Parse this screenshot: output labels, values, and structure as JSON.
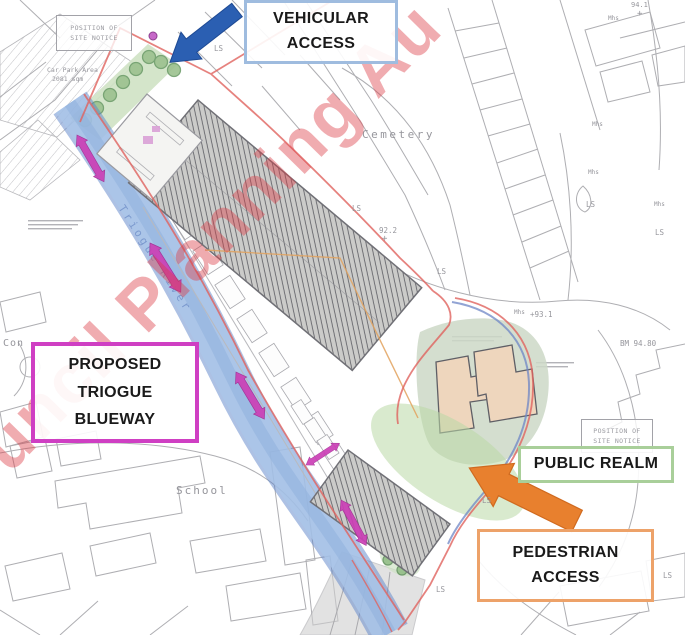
{
  "watermark": {
    "text": "uncil Planning Au"
  },
  "callouts": {
    "vehicular_access": {
      "lines": [
        "VEHICULAR",
        "ACCESS"
      ]
    },
    "proposed_triogue_blueway": {
      "lines": [
        "PROPOSED",
        "TRIOGUE",
        "BLUEWAY"
      ]
    },
    "public_realm": {
      "lines": [
        "PUBLIC REALM"
      ]
    },
    "pedestrian_access": {
      "lines": [
        "PEDESTRIAN",
        "ACCESS"
      ]
    }
  },
  "river_label": "Triogue River",
  "site_notices": [
    {
      "lines": [
        "POSITION OF",
        "SITE NOTICE"
      ],
      "x": 56,
      "y": 15,
      "w": 74,
      "h": 34
    },
    {
      "lines": [
        "POSITION OF",
        "SITE NOTICE"
      ],
      "x": 581,
      "y": 419,
      "w": 70,
      "h": 32
    }
  ],
  "map_labels": [
    {
      "text": "Cemetery",
      "x": 362,
      "y": 128,
      "size": 11,
      "ls": 2.5
    },
    {
      "text": "School",
      "x": 176,
      "y": 484,
      "size": 11,
      "ls": 2
    },
    {
      "text": "Con",
      "x": 3,
      "y": 338,
      "size": 10,
      "ls": 1
    },
    {
      "text": "Car Park Area",
      "x": 47,
      "y": 66,
      "size": 6.5
    },
    {
      "text": "2081 sqm",
      "x": 52,
      "y": 75,
      "size": 6.5
    },
    {
      "text": "92.2",
      "x": 379,
      "y": 226,
      "size": 7.5
    },
    {
      "text": "+",
      "x": 382,
      "y": 234,
      "size": 9
    },
    {
      "text": "+93.1",
      "x": 530,
      "y": 310,
      "size": 7.5
    },
    {
      "text": "BM 94.80",
      "x": 620,
      "y": 339,
      "size": 7.5
    },
    {
      "text": "94.1",
      "x": 631,
      "y": 1,
      "size": 7
    },
    {
      "text": "+",
      "x": 637,
      "y": 9,
      "size": 9
    },
    {
      "text": "LS",
      "x": 214,
      "y": 44,
      "size": 7.5
    },
    {
      "text": "LS",
      "x": 352,
      "y": 204,
      "size": 7.5
    },
    {
      "text": "LS",
      "x": 586,
      "y": 200,
      "size": 7.5
    },
    {
      "text": "LS",
      "x": 655,
      "y": 228,
      "size": 7.5
    },
    {
      "text": "LS",
      "x": 437,
      "y": 267,
      "size": 7.5
    },
    {
      "text": "LS",
      "x": 482,
      "y": 496,
      "size": 7.5
    },
    {
      "text": "LS",
      "x": 436,
      "y": 585,
      "size": 7.5
    },
    {
      "text": "LS",
      "x": 663,
      "y": 571,
      "size": 7.5
    },
    {
      "text": "Mhs",
      "x": 592,
      "y": 121,
      "size": 6
    },
    {
      "text": "Mhs",
      "x": 588,
      "y": 169,
      "size": 6
    },
    {
      "text": "Mhs",
      "x": 654,
      "y": 201,
      "size": 6
    },
    {
      "text": "Mhs",
      "x": 514,
      "y": 309,
      "size": 6
    },
    {
      "text": "Mhs",
      "x": 608,
      "y": 15,
      "size": 6
    }
  ],
  "colors": {
    "vehicular_arrow": "#2b5fb2",
    "pedestrian_arrow": "#e8802e",
    "blueway_arrow": "#cb3fb6",
    "boundary_red": "#e0635f",
    "blueway_fill": "#aac6e8",
    "blueway_edge": "#5b84c9",
    "callout_vehicular_border": "#9fbcdf",
    "callout_blueway_border": "#cf3fc3",
    "callout_public_realm_border": "#a9cf9a",
    "callout_pedestrian_border": "#eda269",
    "watermark": "#dc3c46"
  }
}
